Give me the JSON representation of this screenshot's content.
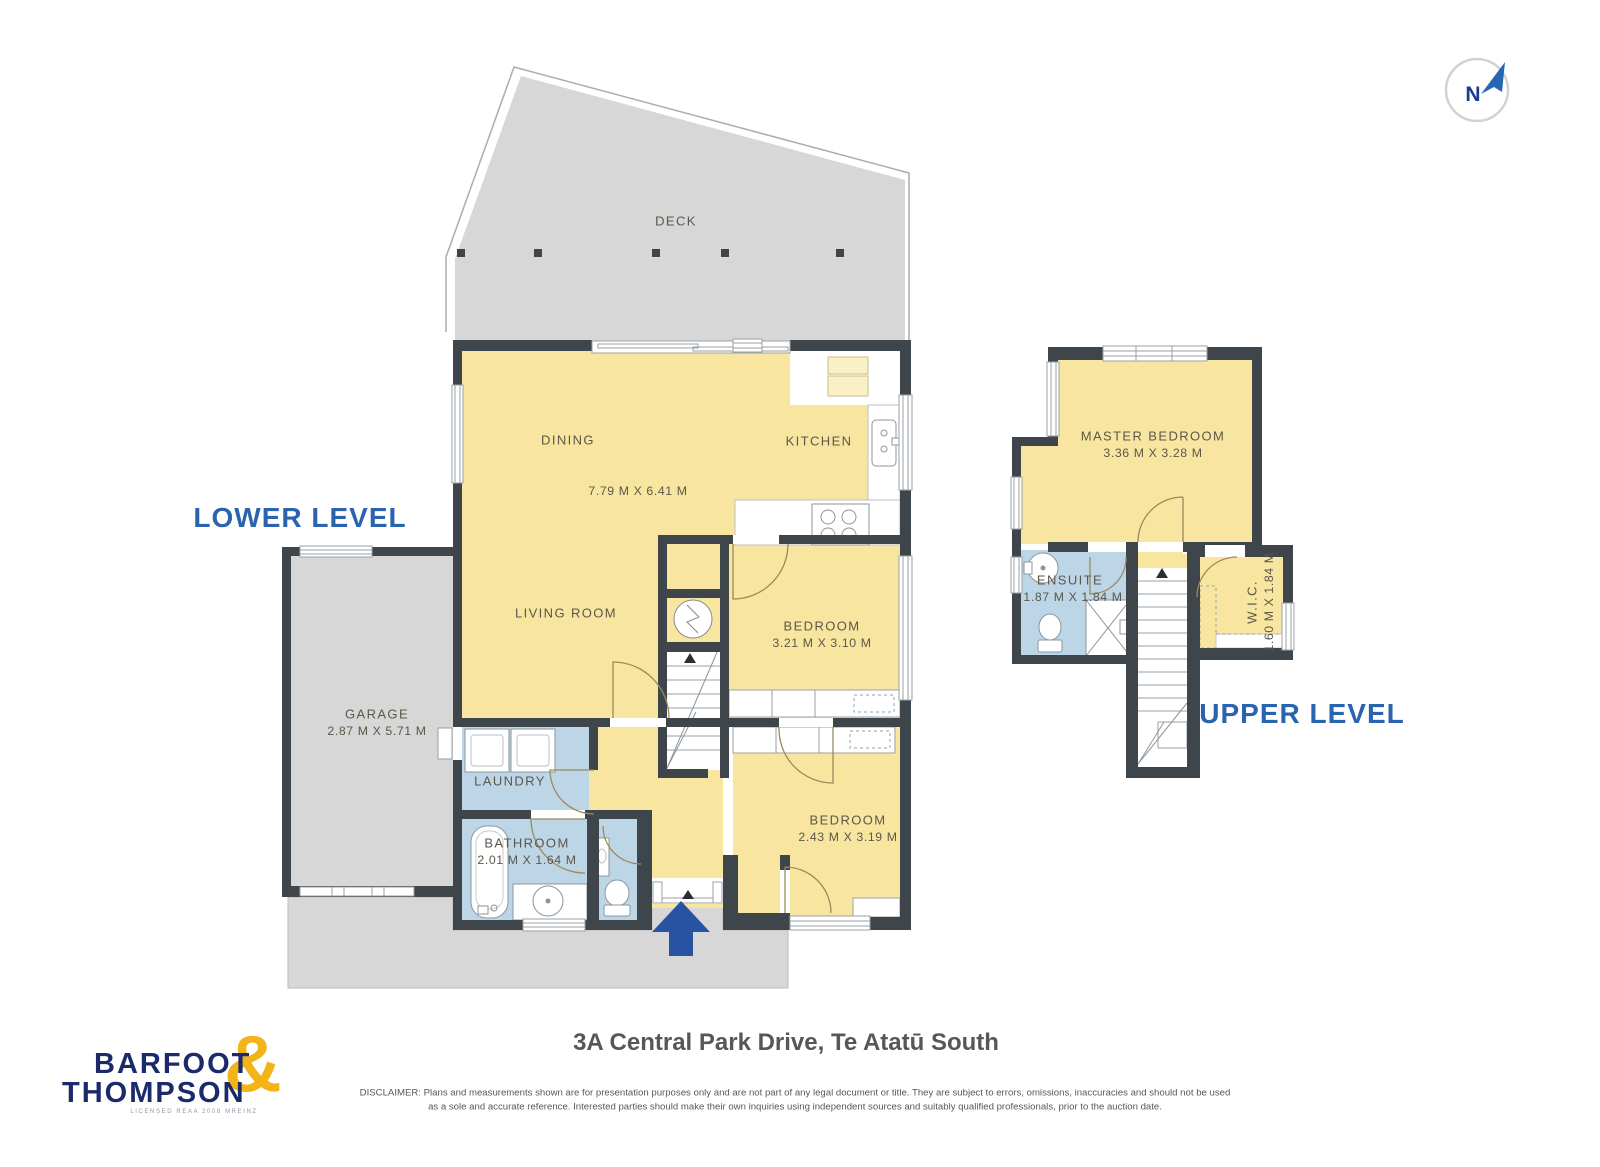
{
  "compass": {
    "north_letter": "N"
  },
  "levels": {
    "lower_label": "LOWER LEVEL",
    "upper_label": "UPPER LEVEL"
  },
  "rooms": {
    "deck": "DECK",
    "dining": "DINING",
    "open_plan_dims": "7.79 M X 6.41 M",
    "kitchen": "KITCHEN",
    "living_room": "LIVING ROOM",
    "garage": "GARAGE",
    "garage_dims": "2.87 M X 5.71 M",
    "laundry": "LAUNDRY",
    "bathroom": "BATHROOM",
    "bathroom_dims": "2.01 M X 1.64 M",
    "bedroom_mid": "BEDROOM",
    "bedroom_mid_dims": "3.21 M X 3.10 M",
    "bedroom_front": "BEDROOM",
    "bedroom_front_dims": "2.43 M X 3.19 M",
    "master_bedroom": "MASTER BEDROOM",
    "master_bedroom_dims": "3.36 M X 3.28 M",
    "ensuite": "ENSUITE",
    "ensuite_dims": "1.87 M X 1.84 M",
    "wic": "W.I.C.",
    "wic_dims": "1.60 M X 1.84 M"
  },
  "footer": {
    "address": "3A Central Park Drive, Te Atatū South",
    "disclaimer_line1": "DISCLAIMER: Plans and measurements shown are for presentation purposes only and are not part of any legal document or title. They are subject to errors, omissions, inaccuracies and should not be used",
    "disclaimer_line2": "as a sole and accurate reference. Interested parties should make their own inquiries using independent sources and suitably qualified professionals, prior to the auction date."
  },
  "brand": {
    "name_line1": "BARFOOT",
    "name_line2": "THOMPSON",
    "ampersand": "&",
    "tagline": "LICENSED REAA 2008 MREINZ"
  },
  "colors": {
    "room_yellow": "#F8E6A0",
    "cabinet_pale_yellow": "#FAF0C6",
    "wet_area_blue": "#BCD6E8",
    "hard_surface_gray": "#D6D7D6",
    "wall_dark": "#3E454B",
    "accent_blue": "#2B64AE",
    "entry_arrow_blue": "#2853A3",
    "brand_navy": "#1B2A6B",
    "brand_gold": "#F2B417",
    "label_olive": "#5C5749"
  }
}
